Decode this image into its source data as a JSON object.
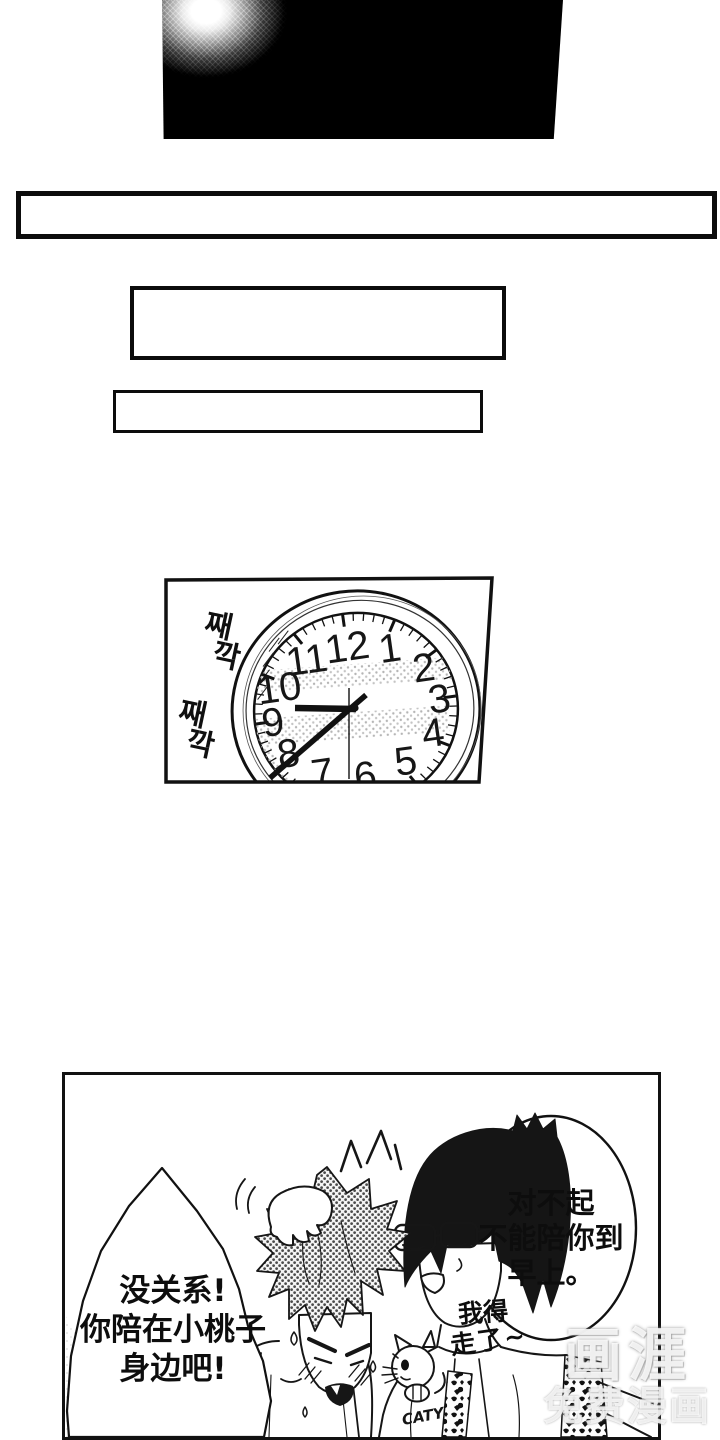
{
  "clock_panel": {
    "clock_numbers": [
      "12",
      "1",
      "2",
      "3",
      "4",
      "5",
      "6",
      "7",
      "8",
      "9",
      "10",
      "11"
    ],
    "sfx": [
      {
        "top": "째",
        "bottom": "깍"
      },
      {
        "top": "째",
        "bottom": "깍"
      }
    ]
  },
  "dialogue": {
    "right_bubble": {
      "lines": [
        "对不起",
        "不能陪你到",
        "早上。"
      ]
    },
    "left_bubble": {
      "lines": [
        "没关系!",
        "你陪在小桃子",
        "身边吧!"
      ]
    },
    "side_note": {
      "line1": "我得",
      "line2": "走了~"
    }
  },
  "shirt_graphic": {
    "label": "CATY"
  },
  "watermark": {
    "logo": "画涯",
    "tagline": "免费漫画"
  },
  "colors": {
    "ink": "#111111",
    "paper": "#ffffff",
    "hair_tone": "#444444"
  }
}
